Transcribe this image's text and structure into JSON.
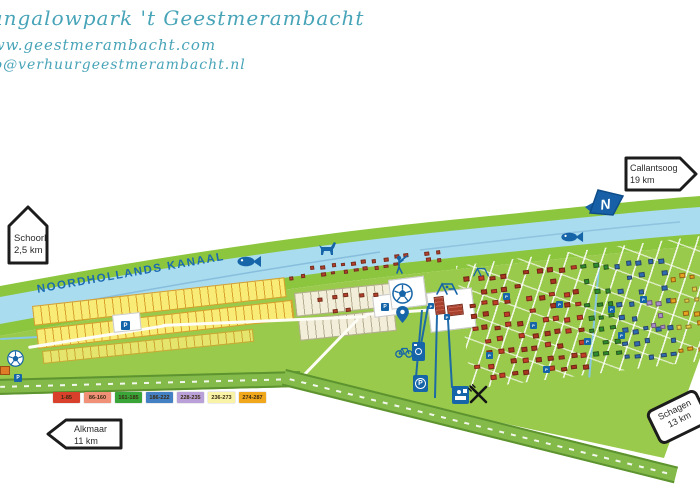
{
  "header": {
    "title": "Bungalowpark 't Geestmerambacht",
    "website": "www.geestmerambacht.com",
    "email": "info@verhuurgeestmerambacht.nl"
  },
  "map": {
    "canal_label": "NOORDHOLLANDS KANAAL",
    "compass_letter": "N",
    "parking_letter": "P",
    "signs": {
      "schoorl": {
        "name": "Schoorl",
        "distance": "2,5 km"
      },
      "callantsoog": {
        "name": "Callantsoog",
        "distance": "19 km"
      },
      "alkmaar": {
        "name": "Alkmaar",
        "distance": "11 km"
      },
      "schagen": {
        "name": "Schagen",
        "distance": "13 km"
      }
    },
    "colors": {
      "water": "#a9dcef",
      "bank_green": "#8cc63e",
      "park_green": "#9aca4c",
      "road_green": "#84ba49",
      "icon_blue": "#1565a8",
      "header_teal": "#48a4b8",
      "canal_text_blue": "#1a6ab3"
    },
    "house_zones": [
      {
        "x": 286,
        "y": 268,
        "w": 158,
        "h": 14,
        "rot": -7,
        "rows": 2,
        "cols": 15,
        "size": 4.5,
        "skip": 0.15,
        "colors": [
          "#b5402c"
        ]
      },
      {
        "x": 298,
        "y": 296,
        "w": 84,
        "h": 46,
        "rot": -6,
        "rows": 3,
        "cols": 6,
        "size": 5,
        "skip": 0.5,
        "colors": [
          "#b5402c"
        ]
      },
      {
        "x": 462,
        "y": 276,
        "w": 118,
        "h": 112,
        "rot": -7,
        "rows": 9,
        "cols": 10,
        "size": 6,
        "skip": 0.3,
        "colors": [
          "#c23c28",
          "#a83420"
        ]
      },
      {
        "x": 578,
        "y": 264,
        "w": 34,
        "h": 100,
        "rot": -7,
        "rows": 8,
        "cols": 3,
        "size": 5.5,
        "skip": 0.25,
        "colors": [
          "#2d8c2f"
        ]
      },
      {
        "x": 610,
        "y": 262,
        "w": 58,
        "h": 106,
        "rot": -7,
        "rows": 8,
        "cols": 5,
        "size": 5.5,
        "skip": 0.28,
        "colors": [
          "#2d6cb3"
        ]
      },
      {
        "x": 644,
        "y": 300,
        "w": 20,
        "h": 34,
        "rot": -7,
        "rows": 3,
        "cols": 2,
        "size": 5.5,
        "skip": 0.15,
        "colors": [
          "#a98fd0"
        ]
      },
      {
        "x": 666,
        "y": 274,
        "w": 32,
        "h": 86,
        "rot": -7,
        "rows": 7,
        "cols": 3,
        "size": 5.5,
        "skip": 0.3,
        "colors": [
          "#e8a31f",
          "#e3cf48"
        ]
      }
    ],
    "parking_squares": [
      {
        "x": 121,
        "y": 321,
        "s": 9
      },
      {
        "x": 14,
        "y": 374,
        "s": 8
      },
      {
        "x": 381,
        "y": 303,
        "s": 8
      },
      {
        "x": 503,
        "y": 293,
        "s": 7
      },
      {
        "x": 530,
        "y": 322,
        "s": 7
      },
      {
        "x": 556,
        "y": 301,
        "s": 7
      },
      {
        "x": 584,
        "y": 338,
        "s": 7
      },
      {
        "x": 618,
        "y": 332,
        "s": 7
      },
      {
        "x": 640,
        "y": 296,
        "s": 7
      },
      {
        "x": 486,
        "y": 352,
        "s": 7
      },
      {
        "x": 543,
        "y": 366,
        "s": 7
      },
      {
        "x": 608,
        "y": 306,
        "s": 7
      },
      {
        "x": 428,
        "y": 303,
        "s": 6
      },
      {
        "x": 444,
        "y": 314,
        "s": 6
      }
    ],
    "leader_lines": [
      {
        "x1": 421,
        "y1": 310,
        "x2": 415,
        "y2": 377
      },
      {
        "x1": 427,
        "y1": 306,
        "x2": 420,
        "y2": 344
      },
      {
        "x1": 436,
        "y1": 315,
        "x2": 434,
        "y2": 398
      },
      {
        "x1": 447,
        "y1": 320,
        "x2": 451,
        "y2": 388
      }
    ]
  },
  "legend": {
    "items": [
      {
        "label": "1-85",
        "color": "#d8402c"
      },
      {
        "label": "86-160",
        "color": "#ef9077"
      },
      {
        "label": "161-185",
        "color": "#39a437"
      },
      {
        "label": "186-222",
        "color": "#4480c4"
      },
      {
        "label": "228-235",
        "color": "#b9a0d8"
      },
      {
        "label": "236-273",
        "color": "#f8f3a6"
      },
      {
        "label": "274-287",
        "color": "#f0a71b"
      }
    ]
  }
}
